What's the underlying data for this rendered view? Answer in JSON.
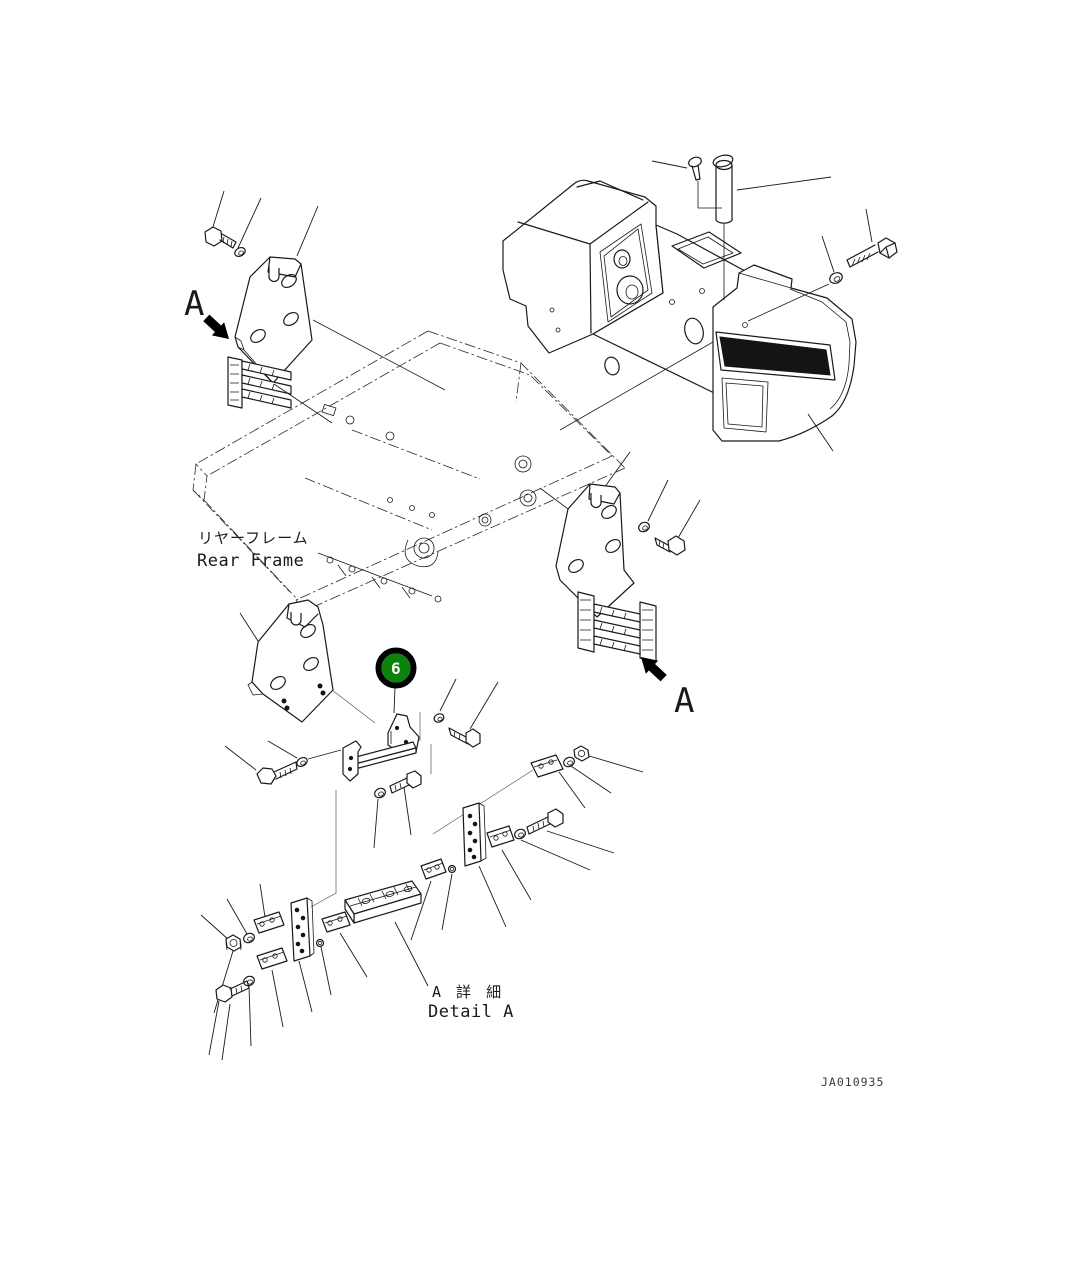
{
  "document": {
    "kind": "parts-diagram",
    "background": "#ffffff",
    "line_color": "#1a1a1a",
    "drawing_number": "JA010935"
  },
  "labels": {
    "view_arrow_top": "A",
    "view_arrow_bottom": "A",
    "rear_frame_jp": "リヤーフレーム",
    "rear_frame_en": "Rear Frame",
    "detail_a_jp": "A 詳 細",
    "detail_a_en": "Detail A"
  },
  "callout": {
    "number": "6",
    "fill": "#0b820b",
    "ring": "#000000",
    "text_color": "#ffffff"
  }
}
